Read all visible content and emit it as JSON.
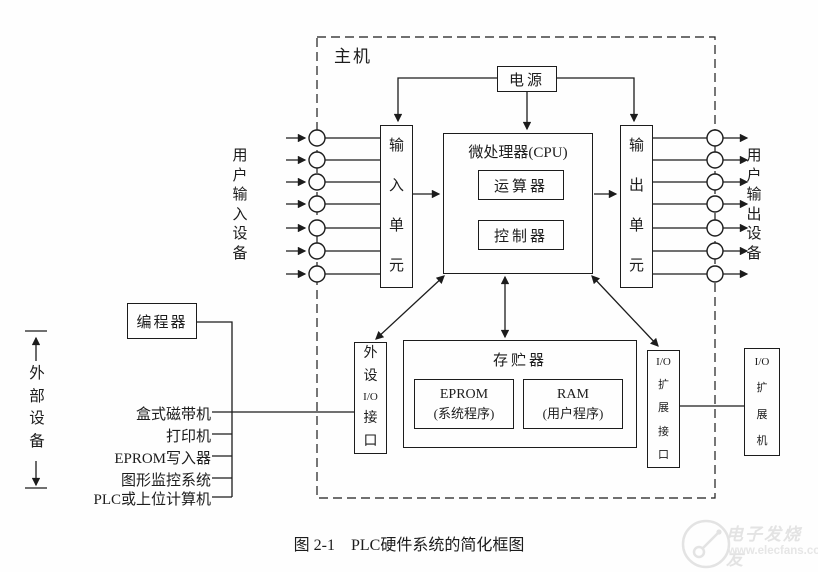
{
  "host": {
    "label": "主机"
  },
  "power": {
    "label": "电源"
  },
  "cpu": {
    "title": "微处理器(CPU)",
    "alu": "运算器",
    "controller": "控制器"
  },
  "input_unit": {
    "chars": [
      "输",
      "入",
      "单",
      "元"
    ]
  },
  "output_unit": {
    "chars": [
      "输",
      "出",
      "单",
      "元"
    ]
  },
  "user_input": {
    "chars": [
      "用",
      "户",
      "输",
      "入",
      "设",
      "备"
    ]
  },
  "user_output": {
    "chars": [
      "用",
      "户",
      "输",
      "出",
      "设",
      "备"
    ]
  },
  "memory": {
    "title": "存贮器",
    "eprom": {
      "line1": "EPROM",
      "line2": "(系统程序)"
    },
    "ram": {
      "line1": "RAM",
      "line2": "(用户程序)"
    }
  },
  "peripheral_io": {
    "chars": [
      "外",
      "设",
      "I/O",
      "接",
      "口"
    ]
  },
  "io_exp_interface": {
    "chars": [
      "I/O",
      "扩",
      "展",
      "接",
      "口"
    ]
  },
  "io_exp_unit": {
    "chars": [
      "I/O",
      "扩",
      "展",
      "机"
    ]
  },
  "programmer": {
    "label": "编程器"
  },
  "external_devices": {
    "chars": [
      "外",
      "部",
      "设",
      "备"
    ]
  },
  "peripherals": [
    "盒式磁带机",
    "打印机",
    "EPROM写入器",
    "图形监控系统",
    "PLC或上位计算机"
  ],
  "caption": "图 2-1　PLC硬件系统的简化框图",
  "watermark": {
    "brand": "电子发烧友",
    "site": "www.elecfans.com"
  },
  "colors": {
    "ink": "#1c1c1c",
    "paper": "#fefefe",
    "watermark": "#e3e3e3"
  }
}
